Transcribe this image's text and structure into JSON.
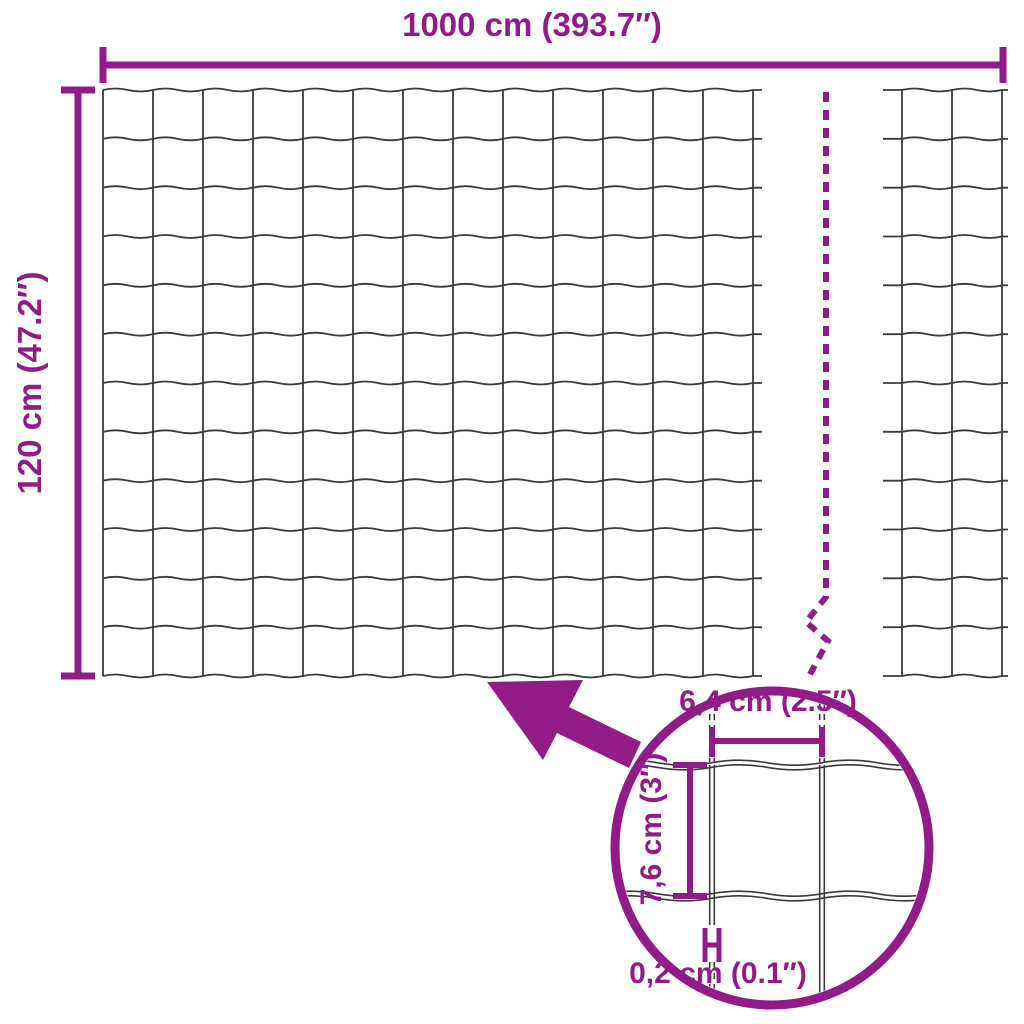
{
  "diagram_title": "wire mesh fence dimensions diagram",
  "colors": {
    "accent": "#911C87",
    "wire": "#3B3B3A",
    "background": "#FFFFFF"
  },
  "labels": {
    "total_width": "1000 cm (393.7″)",
    "total_height": "120 cm (47.2″)",
    "mesh_width": "6,4 cm (2.5″)",
    "mesh_height": "7,6 cm (3″)",
    "wire_thickness": "0,2 cm (0.1″)"
  },
  "mesh": {
    "main_grid": {
      "columns": 13,
      "rows": 12
    },
    "right_grid": {
      "columns": 2,
      "rows": 12
    },
    "magnified_grid": {
      "columns": 2,
      "rows": 1
    }
  }
}
